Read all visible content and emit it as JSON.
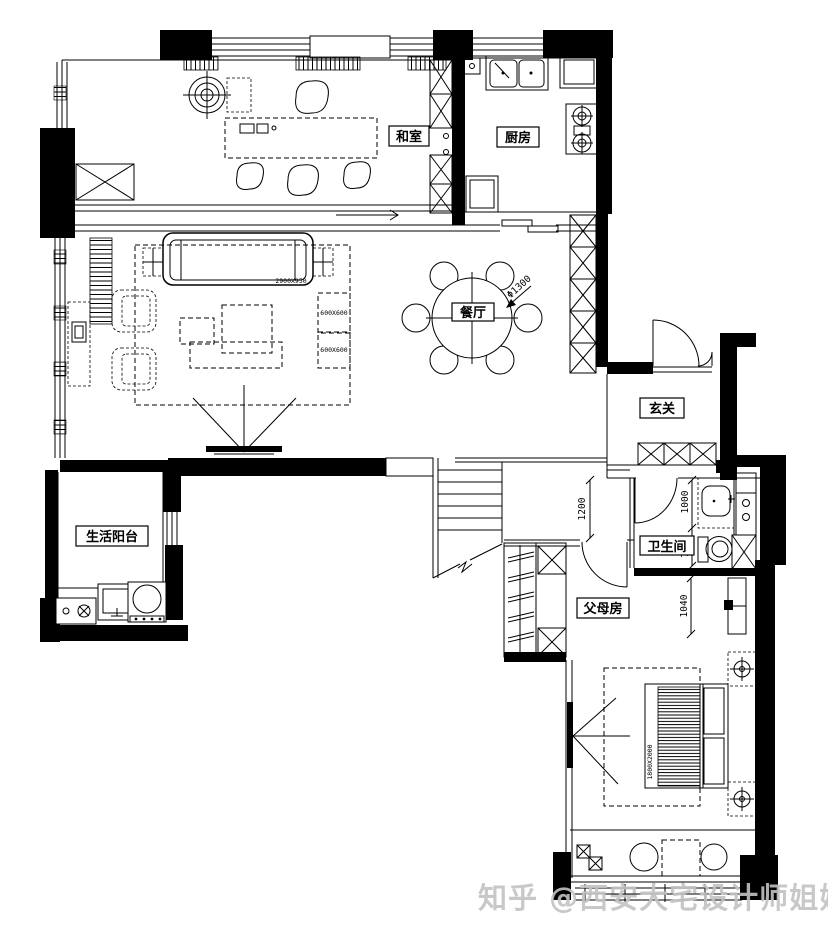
{
  "page": {
    "background": "#ffffff",
    "line_color": "#000000",
    "watermark_color": "#c3c3c3"
  },
  "rooms": {
    "tatami": {
      "label": "和室"
    },
    "kitchen": {
      "label": "厨房"
    },
    "dining": {
      "label": "餐厅"
    },
    "entry": {
      "label": "玄关"
    },
    "balcony": {
      "label": "生活阳台"
    },
    "bathroom": {
      "label": "卫生间"
    },
    "parents": {
      "label": "父母房"
    }
  },
  "dimensions": {
    "dining_table": "Φ1300",
    "corridor": "1200",
    "vanity": "1000",
    "toilet": "770",
    "closet": "1040",
    "sofa": "2900X950",
    "side_table": "600X600",
    "bed": "1800X2000"
  },
  "watermark": {
    "text": "知乎 @西安大宅设计师姐姐"
  }
}
